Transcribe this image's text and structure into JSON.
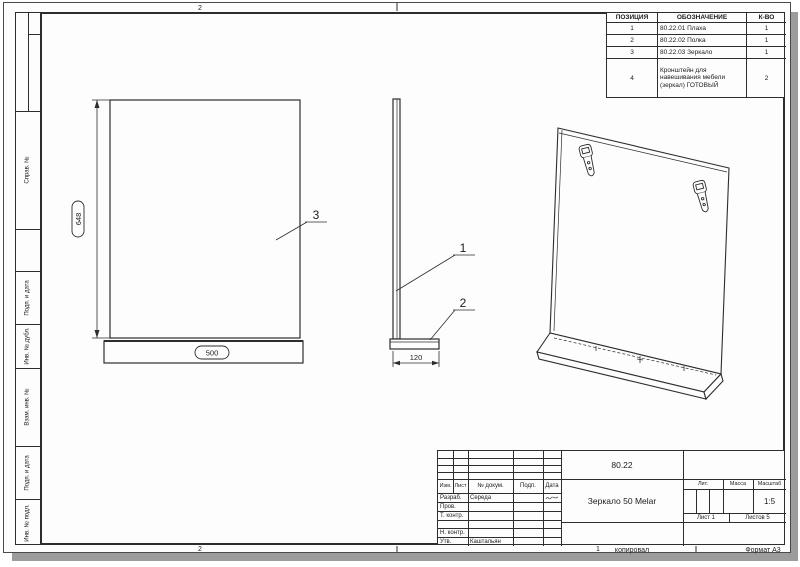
{
  "sheet": {
    "zones": {
      "top_2": "2",
      "bottom_2": "2",
      "bottom_1": "1"
    },
    "footer": {
      "copied": "копировал",
      "format": "Формат А3"
    }
  },
  "left_margin": {
    "labels": [
      "",
      "Справ. №",
      "",
      "Подп. и дата",
      "Инв. № дубл.",
      "Взам. инв. №",
      "Подп. и дата",
      "Инв. № подл."
    ]
  },
  "parts_table": {
    "headers": [
      "ПОЗИЦИЯ",
      "ОБОЗНАЧЕНИЕ",
      "К-ВО"
    ],
    "rows": [
      {
        "pos": "1",
        "name": "80.22.01 Плаха",
        "qty": "1"
      },
      {
        "pos": "2",
        "name": "80.22.02 Полка",
        "qty": "1"
      },
      {
        "pos": "3",
        "name": "80.22.03 Зеркало",
        "qty": "1"
      },
      {
        "pos": "4",
        "name": "Кронштейн для навешивания мебели (зеркал) ГОТОВЫЙ",
        "qty": "2"
      }
    ]
  },
  "drawing": {
    "dimensions": {
      "height": "648",
      "width": "500",
      "depth": "120"
    },
    "callouts": {
      "plank": "1",
      "shelf": "2",
      "mirror": "3"
    }
  },
  "title_block": {
    "doc_number": "80.22",
    "product_name": "Зеркало 50 Melar",
    "columns": [
      "Изм.",
      "Лист",
      "№ докум.",
      "Подп.",
      "Дата"
    ],
    "staff_rows": [
      {
        "label": "Разраб.",
        "name": "Середа"
      },
      {
        "label": "Пров.",
        "name": ""
      },
      {
        "label": "Т. контр.",
        "name": ""
      },
      {
        "label": "",
        "name": ""
      },
      {
        "label": "Н. контр.",
        "name": ""
      },
      {
        "label": "Утв.",
        "name": "Каштальян"
      }
    ],
    "lit": "Лит.",
    "mass": "Масса",
    "scale": "Масштаб",
    "scale_value": "1:5",
    "sheet_no": "Лист 1",
    "sheets_total": "Листов 5"
  },
  "colors": {
    "line": "#2d2d2d",
    "paper": "#fdfdfd",
    "shadow": "#9c9c9c"
  }
}
